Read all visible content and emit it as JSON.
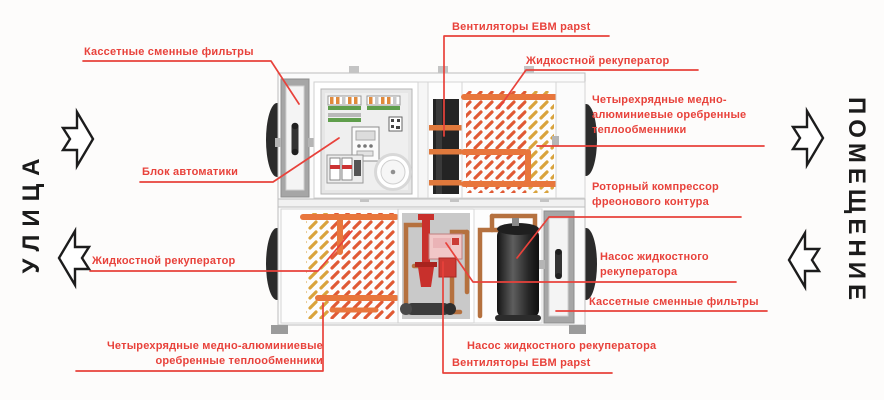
{
  "diagram": {
    "zones": {
      "street": "УЛИЦА",
      "room": "ПОМЕЩЕНИЕ"
    },
    "labels": {
      "filters_top": "Кассетные сменные фильтры",
      "fans_top": "Вентиляторы EBM papst",
      "liquid_recup_top": "Жидкостной рекуператор",
      "hx_right": "Четырехрядные медно-\nалюминиевые оребренные\nтеплообменники",
      "compressor_right": "Роторный компрессор\nфреонового контура",
      "pump_right": "Насос жидкостного\nрекуператора",
      "filters_right": "Кассетные сменные фильтры",
      "liquid_recup_left": "Жидкостной рекуператор",
      "hx_bottom": "Четырехрядные медно-алюминиевые\nоребренные теплообменники",
      "pump_bottom": "Насос жидкостного рекуператора",
      "fans_bottom": "Вентиляторы EBM papst",
      "automation": "Блок автоматики"
    },
    "colors": {
      "label_red": "#e8423b",
      "leader_red": "#e8423b",
      "arrow_outline": "#1c1c1c",
      "coil_orange": "#e05a35",
      "coil_yellow": "#d9a33c",
      "pipe_orange": "#e8763c",
      "copper": "#b5713f",
      "pump_red": "#c8302c",
      "cabinet_gray": "#a6a6a6"
    }
  }
}
